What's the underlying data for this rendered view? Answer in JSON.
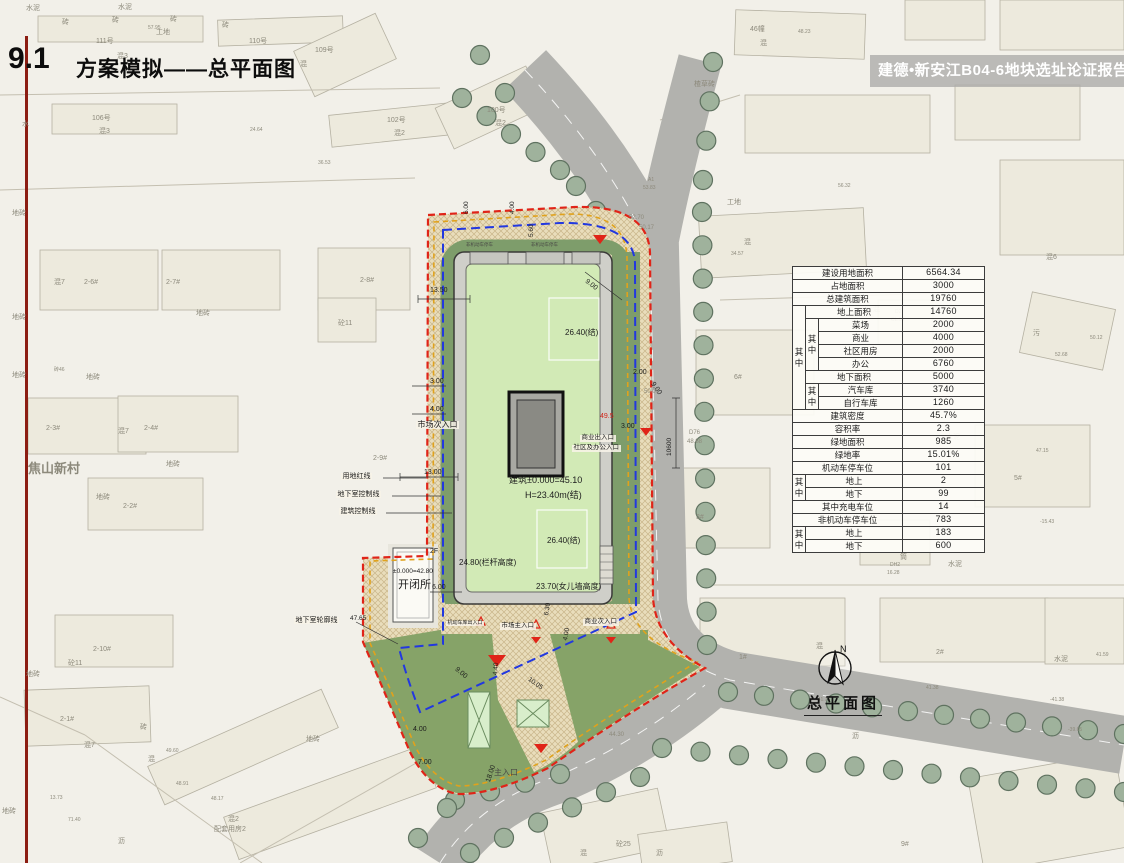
{
  "header": {
    "section_no": "9.1",
    "title": "方案模拟——总平面图"
  },
  "banner": {
    "text": "建德•新安江B04-6地块选址论证报告暨"
  },
  "drawing_caption": {
    "north_label": "N",
    "title": "总平面图"
  },
  "colors": {
    "red_line": "#e02418",
    "blue_line": "#2238e0",
    "orange_line": "#e0a21c",
    "green_band": "#7e9d6b",
    "roof_green": "#d2eab6",
    "road_gray": "#b2b2ae",
    "banner_text": "#ffffff",
    "accent_left_bar": "#8c1d12"
  },
  "stats_table": {
    "rows": [
      [
        {
          "t": "建设用地面积",
          "c": 3
        },
        {
          "t": "6564.34",
          "n": 1
        }
      ],
      [
        {
          "t": "占地面积",
          "c": 3
        },
        {
          "t": "3000",
          "n": 1
        }
      ],
      [
        {
          "t": "总建筑面积",
          "c": 3
        },
        {
          "t": "19760",
          "n": 1
        }
      ],
      [
        {
          "t": "其中",
          "r": 8,
          "v": 1
        },
        {
          "t": "地上面积",
          "c": 2
        },
        {
          "t": "14760",
          "n": 1
        }
      ],
      [
        {
          "t": "其中",
          "r": 4,
          "v": 1
        },
        {
          "t": "菜场"
        },
        {
          "t": "2000",
          "n": 1
        }
      ],
      [
        {
          "t": "商业"
        },
        {
          "t": "4000",
          "n": 1
        }
      ],
      [
        {
          "t": "社区用房"
        },
        {
          "t": "2000",
          "n": 1
        }
      ],
      [
        {
          "t": "办公"
        },
        {
          "t": "6760",
          "n": 1
        }
      ],
      [
        {
          "t": "地下面积",
          "c": 2
        },
        {
          "t": "5000",
          "n": 1
        }
      ],
      [
        {
          "t": "其中",
          "r": 2,
          "v": 1
        },
        {
          "t": "汽车库"
        },
        {
          "t": "3740",
          "n": 1
        }
      ],
      [
        {
          "t": "自行车库"
        },
        {
          "t": "1260",
          "n": 1
        }
      ],
      [
        {
          "t": "建筑密度",
          "c": 3
        },
        {
          "t": "45.7%",
          "n": 1
        }
      ],
      [
        {
          "t": "容积率",
          "c": 3
        },
        {
          "t": "2.3",
          "n": 1
        }
      ],
      [
        {
          "t": "绿地面积",
          "c": 3
        },
        {
          "t": "985",
          "n": 1
        }
      ],
      [
        {
          "t": "绿地率",
          "c": 3
        },
        {
          "t": "15.01%",
          "n": 1
        }
      ],
      [
        {
          "t": "机动车停车位",
          "c": 3
        },
        {
          "t": "101",
          "n": 1
        }
      ],
      [
        {
          "t": "其中",
          "r": 2,
          "v": 1
        },
        {
          "t": "地上",
          "c": 2
        },
        {
          "t": "2",
          "n": 1
        }
      ],
      [
        {
          "t": "地下",
          "c": 2
        },
        {
          "t": "99",
          "n": 1
        }
      ],
      [
        {
          "t": "其中充电车位",
          "c": 3
        },
        {
          "t": "14",
          "n": 1
        }
      ],
      [
        {
          "t": "非机动车停车位",
          "c": 3
        },
        {
          "t": "783",
          "n": 1
        }
      ],
      [
        {
          "t": "其中",
          "r": 2,
          "v": 1
        },
        {
          "t": "地上",
          "c": 2
        },
        {
          "t": "183",
          "n": 1
        }
      ],
      [
        {
          "t": "地下",
          "c": 2
        },
        {
          "t": "600",
          "n": 1
        }
      ]
    ]
  },
  "annotations": [
    {
      "t": "市场次入口",
      "x": 416,
      "y": 421,
      "s": 8,
      "bg": 1
    },
    {
      "t": "13.00",
      "x": 424,
      "y": 469,
      "s": 7
    },
    {
      "t": "用地红线",
      "x": 341,
      "y": 473,
      "s": 7,
      "bg": 1
    },
    {
      "t": "地下室控制线",
      "x": 336,
      "y": 491,
      "s": 7,
      "bg": 1
    },
    {
      "t": "建筑控制线",
      "x": 339,
      "y": 508,
      "s": 7,
      "bg": 1
    },
    {
      "t": "13.50",
      "x": 430,
      "y": 287,
      "s": 7
    },
    {
      "t": "3.00",
      "x": 430,
      "y": 378,
      "s": 7
    },
    {
      "t": "4.00",
      "x": 430,
      "y": 406,
      "s": 7
    },
    {
      "t": "6.00",
      "x": 464,
      "y": 214,
      "s": 6.5,
      "r": -90
    },
    {
      "t": "4.00",
      "x": 510,
      "y": 214,
      "s": 6.5,
      "r": -90
    },
    {
      "t": "5.60",
      "x": 529,
      "y": 237,
      "s": 6.5,
      "r": -90
    },
    {
      "t": "非机动车停车",
      "x": 466,
      "y": 243,
      "s": 4.5,
      "c": "dim"
    },
    {
      "t": "非机动车停车",
      "x": 531,
      "y": 243,
      "s": 4.5,
      "c": "dim"
    },
    {
      "t": "9.00",
      "x": 588,
      "y": 278,
      "s": 7,
      "r": 38
    },
    {
      "t": "2.00",
      "x": 633,
      "y": 369,
      "s": 7
    },
    {
      "t": "9.00",
      "x": 655,
      "y": 381,
      "s": 7,
      "r": 55
    },
    {
      "t": "49.5",
      "x": 600,
      "y": 413,
      "s": 7,
      "c": "red"
    },
    {
      "t": "3.00",
      "x": 621,
      "y": 423,
      "s": 7
    },
    {
      "t": "10600",
      "x": 667,
      "y": 456,
      "s": 6.5,
      "r": -90
    },
    {
      "t": "D76",
      "x": 689,
      "y": 430,
      "s": 6,
      "c": "gray"
    },
    {
      "t": "48.88",
      "x": 687,
      "y": 439,
      "s": 6,
      "c": "gray"
    },
    {
      "t": "50.00",
      "x": 644,
      "y": 389,
      "s": 6,
      "c": "gray"
    },
    {
      "t": "52.70",
      "x": 629,
      "y": 215,
      "s": 6,
      "c": "gray"
    },
    {
      "t": "50.17",
      "x": 639,
      "y": 225,
      "s": 6,
      "c": "gray"
    },
    {
      "t": "商业出入口",
      "x": 580,
      "y": 435,
      "s": 6.5,
      "bg": 1
    },
    {
      "t": "社区及办公入口",
      "x": 572,
      "y": 445,
      "s": 6.5,
      "bg": 1
    },
    {
      "t": "建筑±0.000=45.10",
      "x": 509,
      "y": 476,
      "s": 9
    },
    {
      "t": "H=23.40m(结)",
      "x": 525,
      "y": 491,
      "s": 9
    },
    {
      "t": "26.40(结)",
      "x": 565,
      "y": 329,
      "s": 8
    },
    {
      "t": "26.40(结)",
      "x": 547,
      "y": 537,
      "s": 8
    },
    {
      "t": "24.80(栏杆高度)",
      "x": 459,
      "y": 559,
      "s": 8
    },
    {
      "t": "23.70(女儿墙高度)",
      "x": 536,
      "y": 583,
      "s": 8
    },
    {
      "t": "2F",
      "x": 430,
      "y": 548,
      "s": 7
    },
    {
      "t": "±0.000=42.80",
      "x": 393,
      "y": 569,
      "s": 6.5
    },
    {
      "t": "开闭所",
      "x": 398,
      "y": 580,
      "s": 11
    },
    {
      "t": "6.00",
      "x": 432,
      "y": 584,
      "s": 7
    },
    {
      "t": "47.65",
      "x": 350,
      "y": 616,
      "s": 6.5
    },
    {
      "t": "地下室轮廓线",
      "x": 294,
      "y": 617,
      "s": 7,
      "bg": 1
    },
    {
      "t": "机动车库出入口",
      "x": 446,
      "y": 621,
      "s": 5,
      "bg": 1
    },
    {
      "t": "市场主入口",
      "x": 500,
      "y": 623,
      "s": 6.5,
      "bg": 1
    },
    {
      "t": "商业次入口",
      "x": 583,
      "y": 619,
      "s": 6.5,
      "bg": 1
    },
    {
      "t": "6.30",
      "x": 544,
      "y": 615,
      "s": 6.5,
      "r": -80
    },
    {
      "t": "4.00",
      "x": 563,
      "y": 640,
      "s": 6.5,
      "r": -80
    },
    {
      "t": "9.00",
      "x": 458,
      "y": 666,
      "s": 7,
      "r": 40
    },
    {
      "t": "4.40",
      "x": 493,
      "y": 675,
      "s": 6.5,
      "r": -85
    },
    {
      "t": "10.05",
      "x": 530,
      "y": 677,
      "s": 6.5,
      "r": 35
    },
    {
      "t": "4.00",
      "x": 413,
      "y": 726,
      "s": 7
    },
    {
      "t": "7.00",
      "x": 418,
      "y": 759,
      "s": 7
    },
    {
      "t": "18.00",
      "x": 485,
      "y": 781,
      "s": 7,
      "r": -72
    },
    {
      "t": "主入口",
      "x": 494,
      "y": 769,
      "s": 8,
      "c": "dim"
    },
    {
      "t": "44.30",
      "x": 609,
      "y": 732,
      "s": 6,
      "c": "gray"
    }
  ],
  "map_labels": [
    {
      "t": "水泥",
      "x": 26,
      "y": 5
    },
    {
      "t": "水泥",
      "x": 118,
      "y": 4
    },
    {
      "t": "砖",
      "x": 62,
      "y": 19
    },
    {
      "t": "砖",
      "x": 112,
      "y": 17
    },
    {
      "t": "砖",
      "x": 170,
      "y": 16
    },
    {
      "t": "砖",
      "x": 222,
      "y": 22
    },
    {
      "t": "57.95",
      "x": 148,
      "y": 26,
      "s": 5
    },
    {
      "t": "111号",
      "x": 96,
      "y": 38
    },
    {
      "t": "混3",
      "x": 117,
      "y": 53
    },
    {
      "t": "工地",
      "x": 156,
      "y": 29
    },
    {
      "t": "110号",
      "x": 249,
      "y": 38
    },
    {
      "t": "109号",
      "x": 315,
      "y": 47
    },
    {
      "t": "混",
      "x": 300,
      "y": 61
    },
    {
      "t": "46幢",
      "x": 750,
      "y": 26
    },
    {
      "t": "混",
      "x": 760,
      "y": 40
    },
    {
      "t": "48.23",
      "x": 798,
      "y": 30,
      "s": 5
    },
    {
      "t": "楂草砖",
      "x": 694,
      "y": 81
    },
    {
      "t": "106号",
      "x": 92,
      "y": 115
    },
    {
      "t": "混3",
      "x": 99,
      "y": 128
    },
    {
      "t": "水",
      "x": 22,
      "y": 121
    },
    {
      "t": "102号",
      "x": 387,
      "y": 117
    },
    {
      "t": "混2",
      "x": 394,
      "y": 130
    },
    {
      "t": "100号",
      "x": 487,
      "y": 107
    },
    {
      "t": "混2",
      "x": 495,
      "y": 120
    },
    {
      "t": "24.64",
      "x": 250,
      "y": 128,
      "s": 5
    },
    {
      "t": "36.53",
      "x": 318,
      "y": 161,
      "s": 5
    },
    {
      "t": "地砖",
      "x": 12,
      "y": 210
    },
    {
      "t": "工地",
      "x": 727,
      "y": 199
    },
    {
      "t": "混",
      "x": 744,
      "y": 239
    },
    {
      "t": "34.57",
      "x": 731,
      "y": 252,
      "s": 5
    },
    {
      "t": "56.32",
      "x": 838,
      "y": 184,
      "s": 5
    },
    {
      "t": "A1",
      "x": 648,
      "y": 178,
      "s": 5
    },
    {
      "t": "53.83",
      "x": 643,
      "y": 186,
      "s": 5
    },
    {
      "t": "混7",
      "x": 54,
      "y": 279
    },
    {
      "t": "2-6#",
      "x": 84,
      "y": 279
    },
    {
      "t": "2-7#",
      "x": 166,
      "y": 279
    },
    {
      "t": "2-8#",
      "x": 360,
      "y": 277
    },
    {
      "t": "地砖",
      "x": 12,
      "y": 314
    },
    {
      "t": "地砖",
      "x": 196,
      "y": 310
    },
    {
      "t": "砼11",
      "x": 338,
      "y": 320
    },
    {
      "t": "地砖",
      "x": 12,
      "y": 372
    },
    {
      "t": "地砖",
      "x": 86,
      "y": 374
    },
    {
      "t": "砖46",
      "x": 54,
      "y": 368,
      "s": 5
    },
    {
      "t": "混6",
      "x": 1046,
      "y": 254
    },
    {
      "t": "污",
      "x": 1033,
      "y": 330
    },
    {
      "t": "52.68",
      "x": 1055,
      "y": 353,
      "s": 5
    },
    {
      "t": "50.12",
      "x": 1090,
      "y": 336,
      "s": 5
    },
    {
      "t": "混",
      "x": 873,
      "y": 306
    },
    {
      "t": "D2",
      "x": 895,
      "y": 310,
      "s": 5
    },
    {
      "t": "CL.18",
      "x": 891,
      "y": 318,
      "s": 5
    },
    {
      "t": "6#",
      "x": 734,
      "y": 374
    },
    {
      "t": "水泥",
      "x": 946,
      "y": 434
    },
    {
      "t": "5#",
      "x": 1014,
      "y": 475
    },
    {
      "t": "47.15",
      "x": 1036,
      "y": 449,
      "s": 5
    },
    {
      "t": "2-3#",
      "x": 46,
      "y": 425
    },
    {
      "t": "混7",
      "x": 118,
      "y": 428
    },
    {
      "t": "2-4#",
      "x": 144,
      "y": 425
    },
    {
      "t": "地砖",
      "x": 166,
      "y": 461
    },
    {
      "t": "2-9#",
      "x": 373,
      "y": 455
    },
    {
      "t": "焦山新村",
      "x": 28,
      "y": 462,
      "s": 13,
      "b": 1
    },
    {
      "t": "2-2#",
      "x": 123,
      "y": 503
    },
    {
      "t": "地砖",
      "x": 96,
      "y": 494
    },
    {
      "t": "3#",
      "x": 696,
      "y": 514
    },
    {
      "t": "水泥",
      "x": 948,
      "y": 561
    },
    {
      "t": "筒",
      "x": 900,
      "y": 554
    },
    {
      "t": "DH2",
      "x": 890,
      "y": 563,
      "s": 5
    },
    {
      "t": "16.28",
      "x": 887,
      "y": 571,
      "s": 5
    },
    {
      "t": "-15.43",
      "x": 1040,
      "y": 520,
      "s": 5
    },
    {
      "t": "2-10#",
      "x": 93,
      "y": 646
    },
    {
      "t": "砼11",
      "x": 68,
      "y": 660
    },
    {
      "t": "地砖",
      "x": 26,
      "y": 671
    },
    {
      "t": "1#",
      "x": 739,
      "y": 654
    },
    {
      "t": "混",
      "x": 816,
      "y": 643
    },
    {
      "t": "2#",
      "x": 936,
      "y": 649
    },
    {
      "t": "水泥",
      "x": 1054,
      "y": 656
    },
    {
      "t": "41.59",
      "x": 1096,
      "y": 653,
      "s": 5
    },
    {
      "t": "41.38",
      "x": 926,
      "y": 686,
      "s": 5
    },
    {
      "t": "2-1#",
      "x": 60,
      "y": 716
    },
    {
      "t": "砖",
      "x": 140,
      "y": 724
    },
    {
      "t": "混7",
      "x": 84,
      "y": 742
    },
    {
      "t": "混",
      "x": 148,
      "y": 756
    },
    {
      "t": "49.60",
      "x": 166,
      "y": 749,
      "s": 5
    },
    {
      "t": "48.91",
      "x": 176,
      "y": 782,
      "s": 5
    },
    {
      "t": "48.17",
      "x": 211,
      "y": 797,
      "s": 5
    },
    {
      "t": "混2",
      "x": 228,
      "y": 816
    },
    {
      "t": "配套用房2",
      "x": 214,
      "y": 826
    },
    {
      "t": "沥",
      "x": 118,
      "y": 838
    },
    {
      "t": "地砖",
      "x": 2,
      "y": 808
    },
    {
      "t": "71.40",
      "x": 68,
      "y": 818,
      "s": 5
    },
    {
      "t": "13.73",
      "x": 50,
      "y": 796,
      "s": 5
    },
    {
      "t": "沥",
      "x": 852,
      "y": 733
    },
    {
      "t": "9#",
      "x": 901,
      "y": 841
    },
    {
      "t": "混",
      "x": 580,
      "y": 850
    },
    {
      "t": "砼25",
      "x": 616,
      "y": 841
    },
    {
      "t": "沥",
      "x": 656,
      "y": 850
    },
    {
      "t": "地砖",
      "x": 306,
      "y": 736
    },
    {
      "t": "-41.70",
      "x": 816,
      "y": 698,
      "s": 5
    },
    {
      "t": "-41.38",
      "x": 1050,
      "y": 698,
      "s": 5
    },
    {
      "t": "-39.65",
      "x": 1068,
      "y": 728,
      "s": 5
    }
  ]
}
